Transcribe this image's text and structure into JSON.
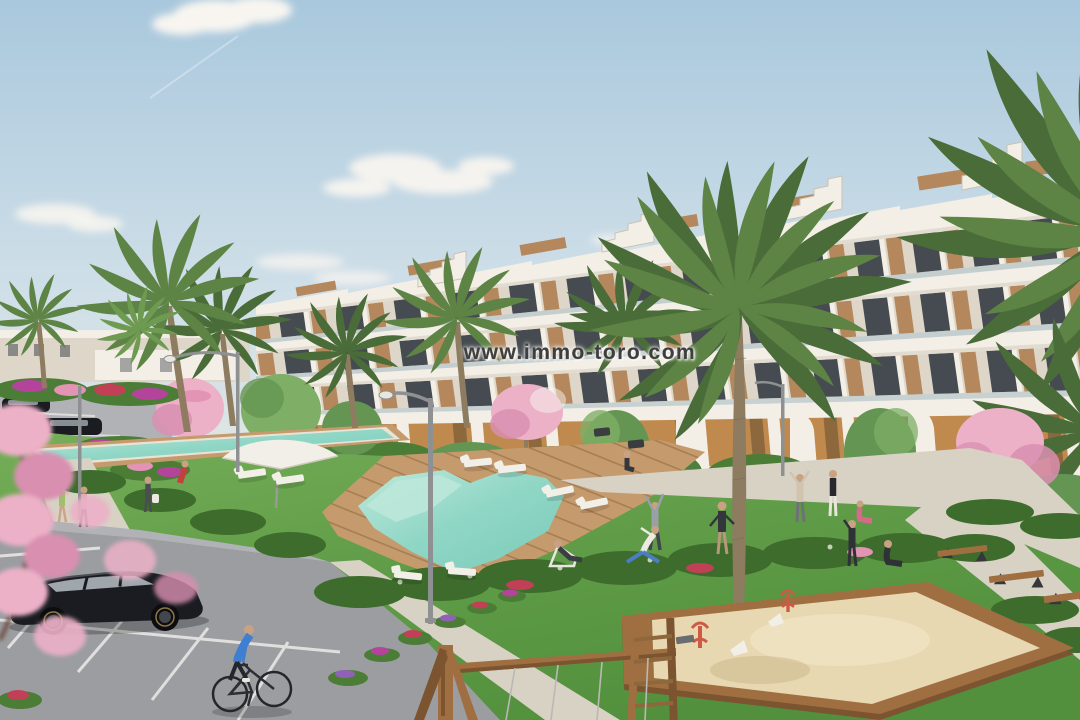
{
  "watermark": {
    "text": "www.immo-toro.com"
  },
  "colors": {
    "sky_top": "#a9c8dd",
    "sky_mid": "#cfdfe8",
    "sky_low": "#e4e7e2",
    "horizon": "#efe9dd",
    "cloud": "#f8f5f0",
    "bld_white": "#f3efe6",
    "bld_shade": "#ddd6c9",
    "bld_dark": "#454b50",
    "wood": "#b4885c",
    "wood_dark": "#8d683c",
    "ochre": "#c08a4f",
    "glass": "#9db3bb",
    "grass_light": "#76ae59",
    "grass": "#619d48",
    "grass_dark": "#52903d",
    "bush": "#4c7d36",
    "hedge": "#3d6c2c",
    "tree_light": "#7fae67",
    "tree_mid": "#649553",
    "tree_dark": "#4d7f3e",
    "palm": "#5d8345",
    "palm_dark": "#4a6c39",
    "palm_light": "#6f9a52",
    "trunk": "#8d7c60",
    "pool": "#8fd6c5",
    "pool_light": "#bde8da",
    "pool_deep": "#7ccabb",
    "coping": "#e9e3d5",
    "deck": "#c59b6e",
    "deck_dark": "#a57e52",
    "path": "#d8d2c5",
    "asphalt": "#9b9da1",
    "asphalt_light": "#b0b2b5",
    "line_white": "#e8e7e4",
    "blossom": "#ecb0c7",
    "blossom_dark": "#d98fb0",
    "fl_red": "#c24056",
    "fl_mag": "#b4449b",
    "fl_purple": "#8f62b8",
    "fl_pink": "#e393b4",
    "sand": "#e7d8b2",
    "sand_light": "#f1e6c6",
    "sand_dark": "#c9b488",
    "wood_play": "#a06f41",
    "wood_play_dark": "#7c5530",
    "car": "#1a1c21",
    "car_glass": "#b7c0c6",
    "metal": "#8e9092",
    "skin": "#c9a183",
    "red_toy": "#cc5a47",
    "furn_white": "#f2efe8",
    "wm": "#3f3e3c"
  }
}
